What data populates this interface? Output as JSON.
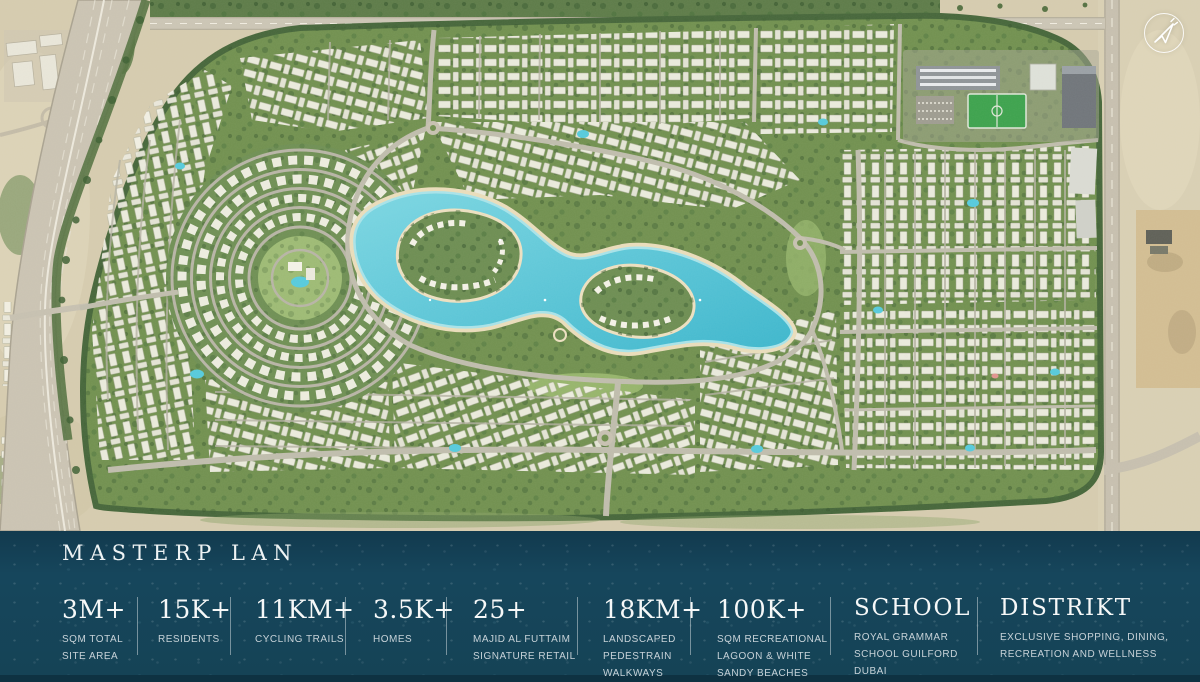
{
  "brand": {
    "logo_icon": "paper-plane-icon"
  },
  "masterplan": {
    "title": "MASTERP LAN",
    "stats": [
      {
        "value": "3M+",
        "label": "SQM TOTAL SITE AREA"
      },
      {
        "value": "15K+",
        "label": "RESIDENTS"
      },
      {
        "value": "11KM+",
        "label": "CYCLING TRAILS"
      },
      {
        "value": "3.5K+",
        "label": "HOMES"
      },
      {
        "value": "25+",
        "label": "MAJID AL FUTTAIM SIGNATURE RETAIL"
      },
      {
        "value": "18KM+",
        "label": "LANDSCAPED PEDESTRAIN WALKWAYS"
      },
      {
        "value": "100K+",
        "label": "SQM RECREATIONAL LAGOON & WHITE SANDY BEACHES"
      },
      {
        "value": "SCHOOL",
        "label": "ROYAL GRAMMAR SCHOOL GUILFORD DUBAI"
      },
      {
        "value": "DISTRIKT",
        "label": "EXCLUSIVE SHOPPING, DINING, RECREATION AND WELLNESS"
      }
    ]
  },
  "map": {
    "colors": {
      "band": "#16465c",
      "desert": "#d5cbae",
      "greenery": "#71904f",
      "lagoon": "#3db6cc",
      "lagoon_light": "#7cd6e2",
      "sand": "#e9dcba",
      "roads": "#bfbcac",
      "roofs": "#f3f1e6",
      "pitch": "#3da24d"
    }
  }
}
